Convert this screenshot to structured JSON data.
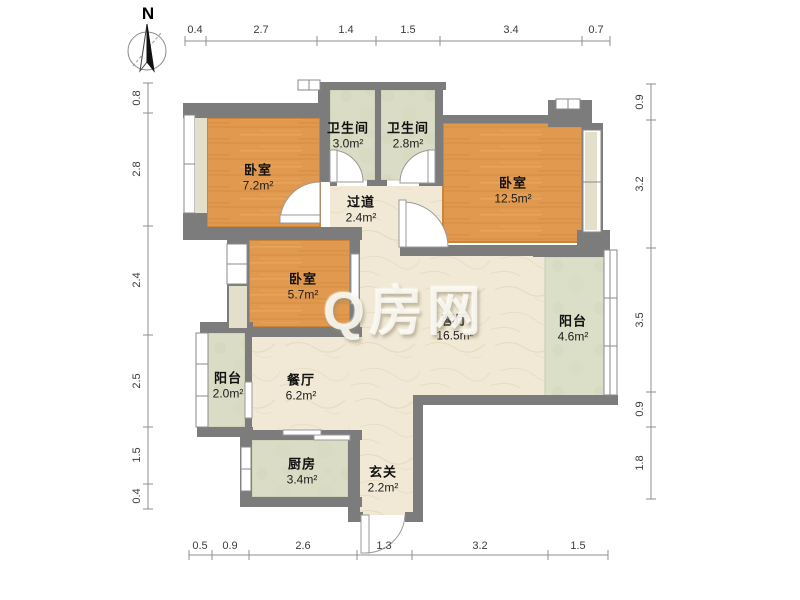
{
  "watermark": {
    "text": "Q房网"
  },
  "compass": {
    "label": "N"
  },
  "rooms": {
    "bedroom_top_left": {
      "name": "卧室",
      "area": "7.2m²"
    },
    "bathroom_left": {
      "name": "卫生间",
      "area": "3.0m²"
    },
    "bathroom_right": {
      "name": "卫生间",
      "area": "2.8m²"
    },
    "bedroom_right": {
      "name": "卧室",
      "area": "12.5m²"
    },
    "hallway": {
      "name": "过道",
      "area": "2.4m²"
    },
    "bedroom_middle": {
      "name": "卧室",
      "area": "5.7m²"
    },
    "living_room": {
      "name": "客厅",
      "area": "16.5m²"
    },
    "balcony_right": {
      "name": "阳台",
      "area": "4.6m²"
    },
    "balcony_left": {
      "name": "阳台",
      "area": "2.0m²"
    },
    "dining_room": {
      "name": "餐厅",
      "area": "6.2m²"
    },
    "kitchen": {
      "name": "厨房",
      "area": "3.4m²"
    },
    "entry": {
      "name": "玄关",
      "area": "2.2m²"
    }
  },
  "dimensions": {
    "top": [
      "0.4",
      "2.7",
      "1.4",
      "1.5",
      "3.4",
      "0.7"
    ],
    "left": [
      "0.8",
      "2.8",
      "2.4",
      "2.5",
      "1.5",
      "0.4"
    ],
    "right": [
      "0.9",
      "3.2",
      "3.5",
      "0.9",
      "1.8"
    ],
    "bottom": [
      "0.5",
      "0.9",
      "2.6",
      "1.3",
      "3.2",
      "1.5"
    ]
  },
  "colors": {
    "wall": "#7c7c7c",
    "wood_floor": "#e0994e",
    "tile_floor": "#dadcc5",
    "marble_floor": "#f1e9d5",
    "dimension_text": "#3c3c3c",
    "watermark": "#fdfcf6"
  }
}
